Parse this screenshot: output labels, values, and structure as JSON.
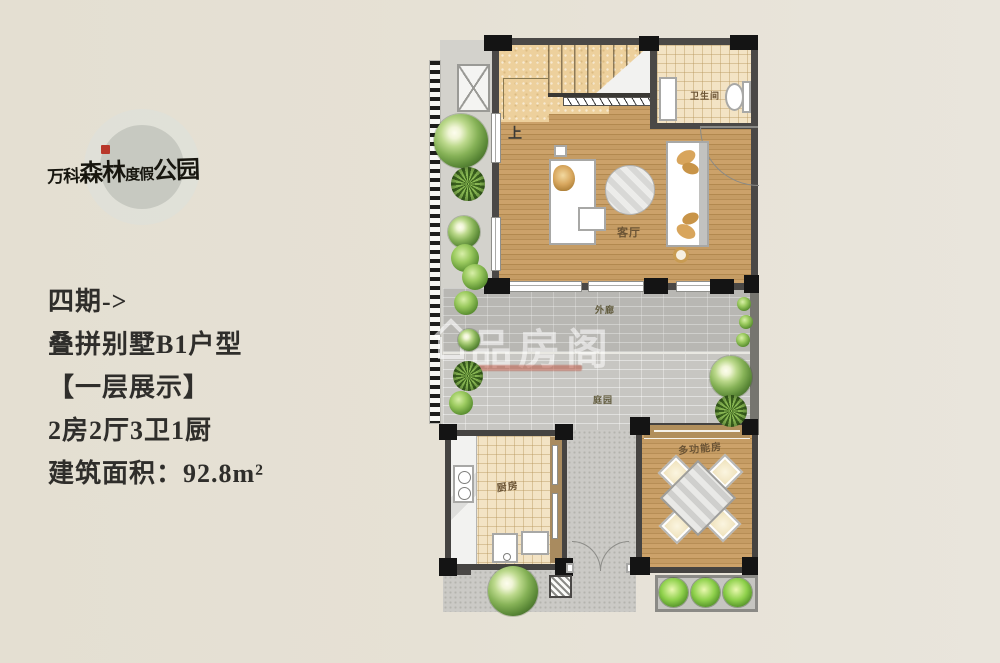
{
  "logo": {
    "parts": [
      "万科",
      "森林",
      "度假",
      "公园"
    ]
  },
  "info": {
    "lines": [
      "四期->",
      "叠拼别墅B1户型",
      "【一层展示】",
      "2房2厅3卫1厨",
      "建筑面积：92.8m²"
    ]
  },
  "floorplan": {
    "labels": {
      "stairs_up": "上",
      "bathroom": "卫生间",
      "living_room": "客厅",
      "corridor": "外廊",
      "courtyard": "庭园",
      "kitchen": "厨房",
      "multifunction_room": "多功能房"
    },
    "watermark": {
      "text": "品房阁"
    }
  },
  "colors": {
    "background": "#E6E1D6",
    "wall": "#4A4846",
    "wood_floor": "#C0975F",
    "stair_stone": "#EDD09C",
    "tile_floor": "#F3E3C4",
    "brick_paving": "#C7C6C2",
    "room_label": "#6B5435",
    "logo_seal": "#B8372A"
  }
}
